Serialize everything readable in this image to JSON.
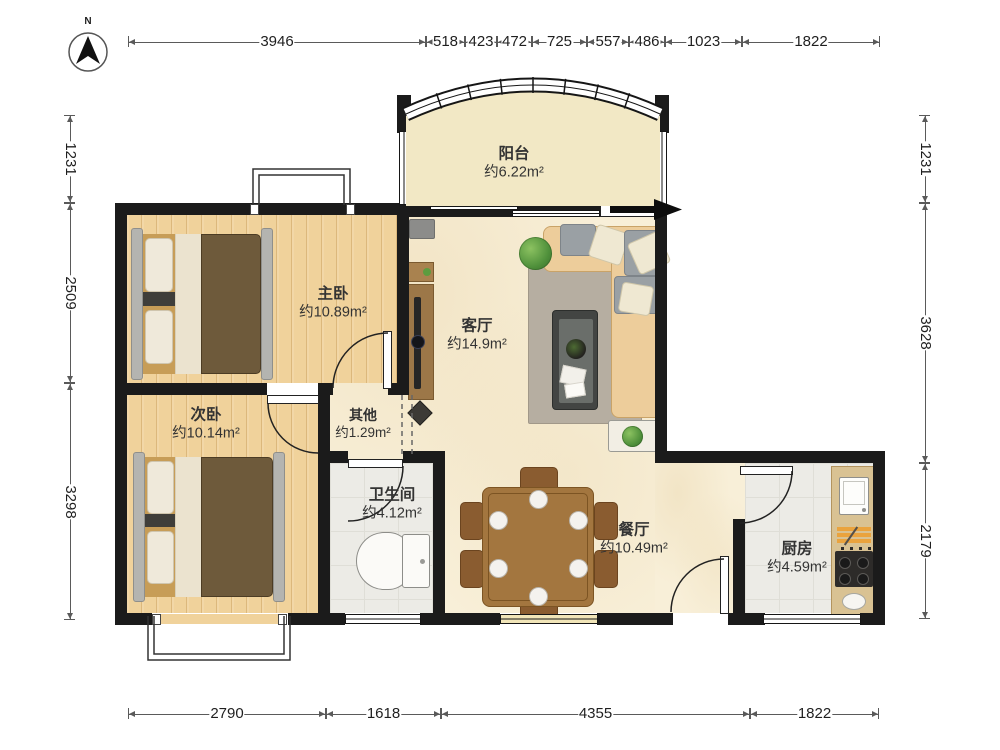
{
  "compass": {
    "north_label": "N"
  },
  "dimensions": {
    "top": [
      "3946",
      "518",
      "423",
      "472",
      "725",
      "557",
      "486",
      "1023",
      "1822"
    ],
    "bottom": [
      "2790",
      "1618",
      "4355",
      "1822"
    ],
    "left": [
      "1231",
      "2509",
      "3298"
    ],
    "right": [
      "1231",
      "3628",
      "2179"
    ]
  },
  "rooms": [
    {
      "id": "balcony",
      "name": "阳台",
      "area": "约6.22m²"
    },
    {
      "id": "master-bedroom",
      "name": "主卧",
      "area": "约10.89m²"
    },
    {
      "id": "living-room",
      "name": "客厅",
      "area": "约14.9m²"
    },
    {
      "id": "second-bedroom",
      "name": "次卧",
      "area": "约10.14m²"
    },
    {
      "id": "other",
      "name": "其他",
      "area": "约1.29m²"
    },
    {
      "id": "bathroom",
      "name": "卫生间",
      "area": "约4.12m²"
    },
    {
      "id": "dining-room",
      "name": "餐厅",
      "area": "约10.49m²"
    },
    {
      "id": "kitchen",
      "name": "厨房",
      "area": "约4.59m²"
    }
  ],
  "colors": {
    "wall": "#1b1b1b",
    "wood_floor": "#f0d29b",
    "balcony_floor": "#f2e8c5",
    "living_floor": "#f8efd8",
    "wet_floor": "#ecebe6",
    "sofa": "#edcd9b",
    "bed_duvet": "#6e5a3b",
    "dining_wood": "#a3763f",
    "kitchen_counter": "#d9c293",
    "rug": "#b6aea1",
    "plant": "#4e8f3a",
    "dimension_text": "#1f1f1f"
  }
}
